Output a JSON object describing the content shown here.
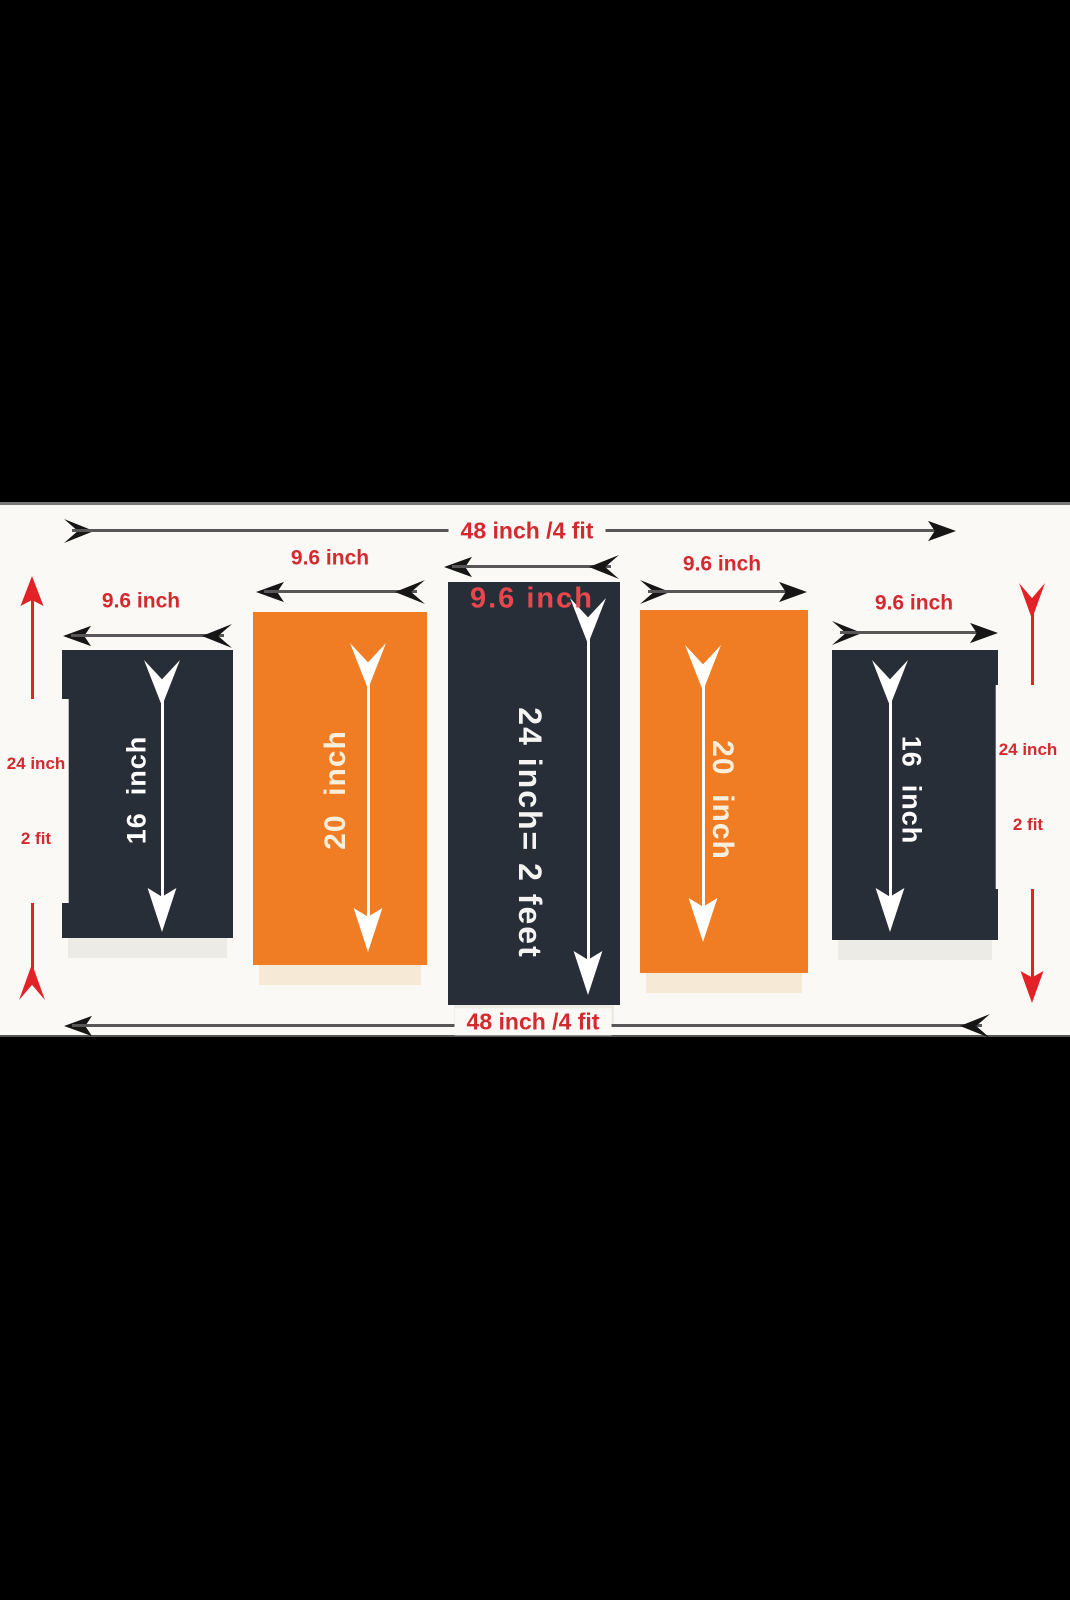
{
  "diagram": {
    "description": "5 panel wall frame size diagram",
    "overall": {
      "top_width": "48 inch /4 fit",
      "bottom_width": "48 inch /4 fit",
      "center_width_overlay": "9.6 inch",
      "left_height": {
        "line1": "24 inch",
        "line2": "2 fit"
      },
      "right_height": {
        "line1": "24 inch",
        "line2": "2 fit"
      }
    },
    "panels": [
      {
        "id": "panel-1",
        "fill": "dark",
        "width_label": "9.6 inch",
        "height_text": "16  inch"
      },
      {
        "id": "panel-2",
        "fill": "orange",
        "width_label": "9.6 inch",
        "height_text": "20  inch"
      },
      {
        "id": "panel-3",
        "fill": "dark",
        "width_label": "9.6 inch",
        "height_text": "24 inch= 2 feet"
      },
      {
        "id": "panel-4",
        "fill": "orange",
        "width_label": "9.6 inch",
        "height_text": "20  inch"
      },
      {
        "id": "panel-5",
        "fill": "dark",
        "width_label": "9.6 inch",
        "height_text": "16  inch"
      }
    ],
    "colors": {
      "panel_dark": "#282e38",
      "panel_orange": "#f07c23",
      "label_red": "#d32a2f",
      "overlay_red": "#e8474e",
      "arrow_red": "#e32227",
      "arrow_black": "#161616",
      "arrow_line_grey": "#575757",
      "panel_text_white": "#ffffff",
      "panel_text_cream": "#f9efdc",
      "canvas_background": "#faf9f5",
      "letterbox": "#000000"
    }
  }
}
